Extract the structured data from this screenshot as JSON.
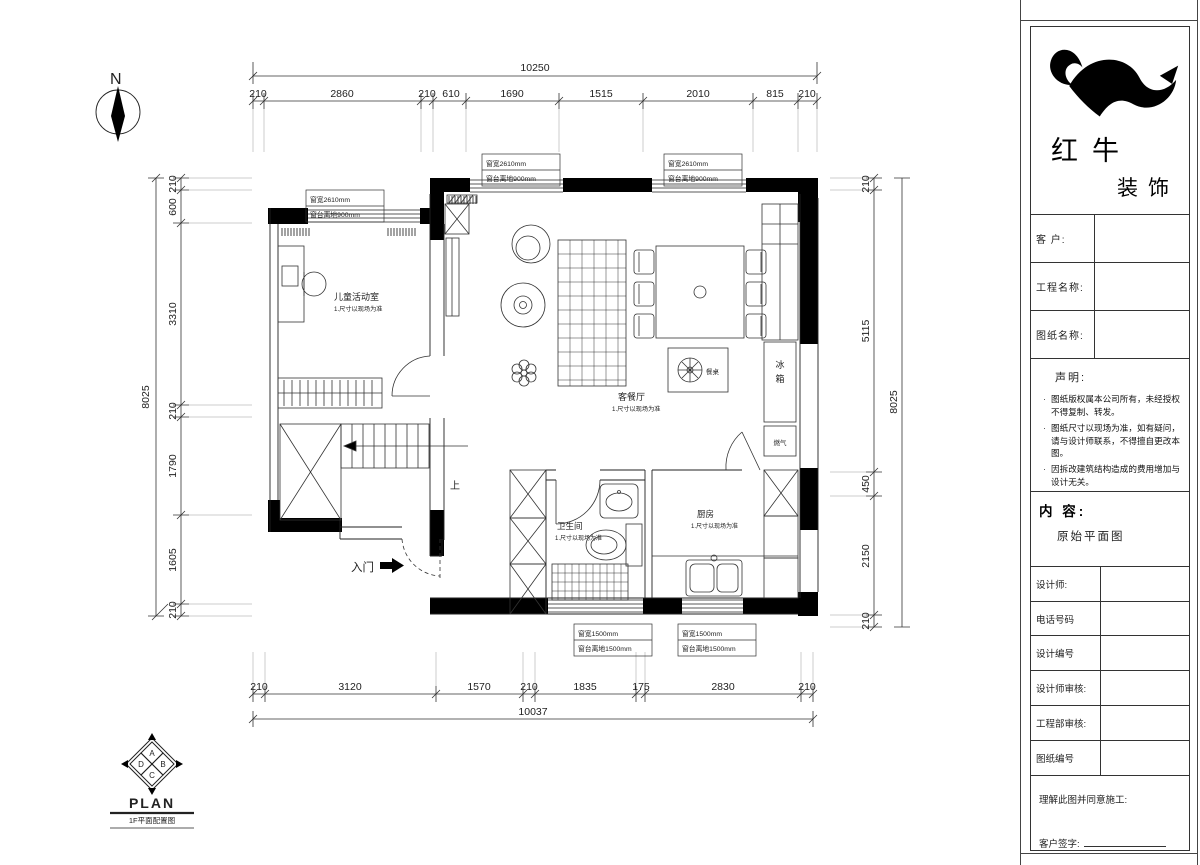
{
  "north": {
    "label": "N"
  },
  "dims": {
    "top": {
      "overall": "10250",
      "segments": [
        "210",
        "2860",
        "210",
        "610",
        "1690",
        "1515",
        "2010",
        "815",
        "210"
      ]
    },
    "bottom": {
      "overall": "10037",
      "segments": [
        "210",
        "3120",
        "1570",
        "210",
        "1835",
        "175",
        "2830",
        "210"
      ]
    },
    "left": {
      "overall": "8025",
      "segments": [
        "210",
        "600",
        "3310",
        "210",
        "1790",
        "1605",
        "210"
      ]
    },
    "right": {
      "overall": "8025",
      "segments": [
        "210",
        "5115",
        "450",
        "2150",
        "210"
      ]
    }
  },
  "plan": {
    "entry": "入门",
    "stair_up": "上",
    "rooms": {
      "kids": {
        "name": "儿童活动室",
        "note": "1.尺寸以现场为准"
      },
      "living": {
        "name": "客餐厅",
        "note": "1.尺寸以现场为准"
      },
      "bath": {
        "name": "卫生间",
        "note": "1.尺寸以现场为准"
      },
      "kitchen": {
        "name": "厨房",
        "note": "1.尺寸以现场为准"
      }
    },
    "cabinet": {
      "fridge": [
        "冰",
        "箱"
      ],
      "gas": "燃气",
      "plant_table": "餐桌"
    },
    "windows": {
      "w1": {
        "line1": "窗宽2610mm",
        "line2": "窗台离地900mm"
      },
      "w2": {
        "line1": "窗宽2610mm",
        "line2": "窗台离地900mm"
      },
      "w3": {
        "line1": "窗宽2610mm",
        "line2": "窗台离地900mm"
      },
      "w4": {
        "line1": "窗宽1500mm",
        "line2": "窗台离地1500mm"
      },
      "w5": {
        "line1": "窗宽1500mm",
        "line2": "窗台离地1500mm"
      }
    }
  },
  "plan_symbol": {
    "letters": [
      "A",
      "B",
      "C",
      "D"
    ],
    "title": "PLAN",
    "subtitle": "1F平面配置图"
  },
  "titleblock": {
    "brand": {
      "name_top": "红牛",
      "name_bottom": "装饰"
    },
    "rows": {
      "client": "客  户:",
      "project": "工程名称:",
      "drawing": "图纸名称:",
      "designer": "设计师:",
      "phone": "电话号码",
      "design_no": "设计编号",
      "designer_audit": "设计师审核:",
      "dept_audit": "工程部审核:",
      "sheet_no": "图纸编号"
    },
    "statement": {
      "title": "声明:",
      "items": [
        "图纸版权属本公司所有，未经授权不得复制、转发。",
        "图纸尺寸以现场为准，如有疑问，请与设计师联系，不得擅自更改本图。",
        "因拆改建筑结构造成的费用增加与设计无关。"
      ]
    },
    "content": {
      "label": "内  容:",
      "value": "原始平面图"
    },
    "footer": {
      "agree": "理解此图并同意施工:",
      "sign": "客户签字:"
    }
  }
}
